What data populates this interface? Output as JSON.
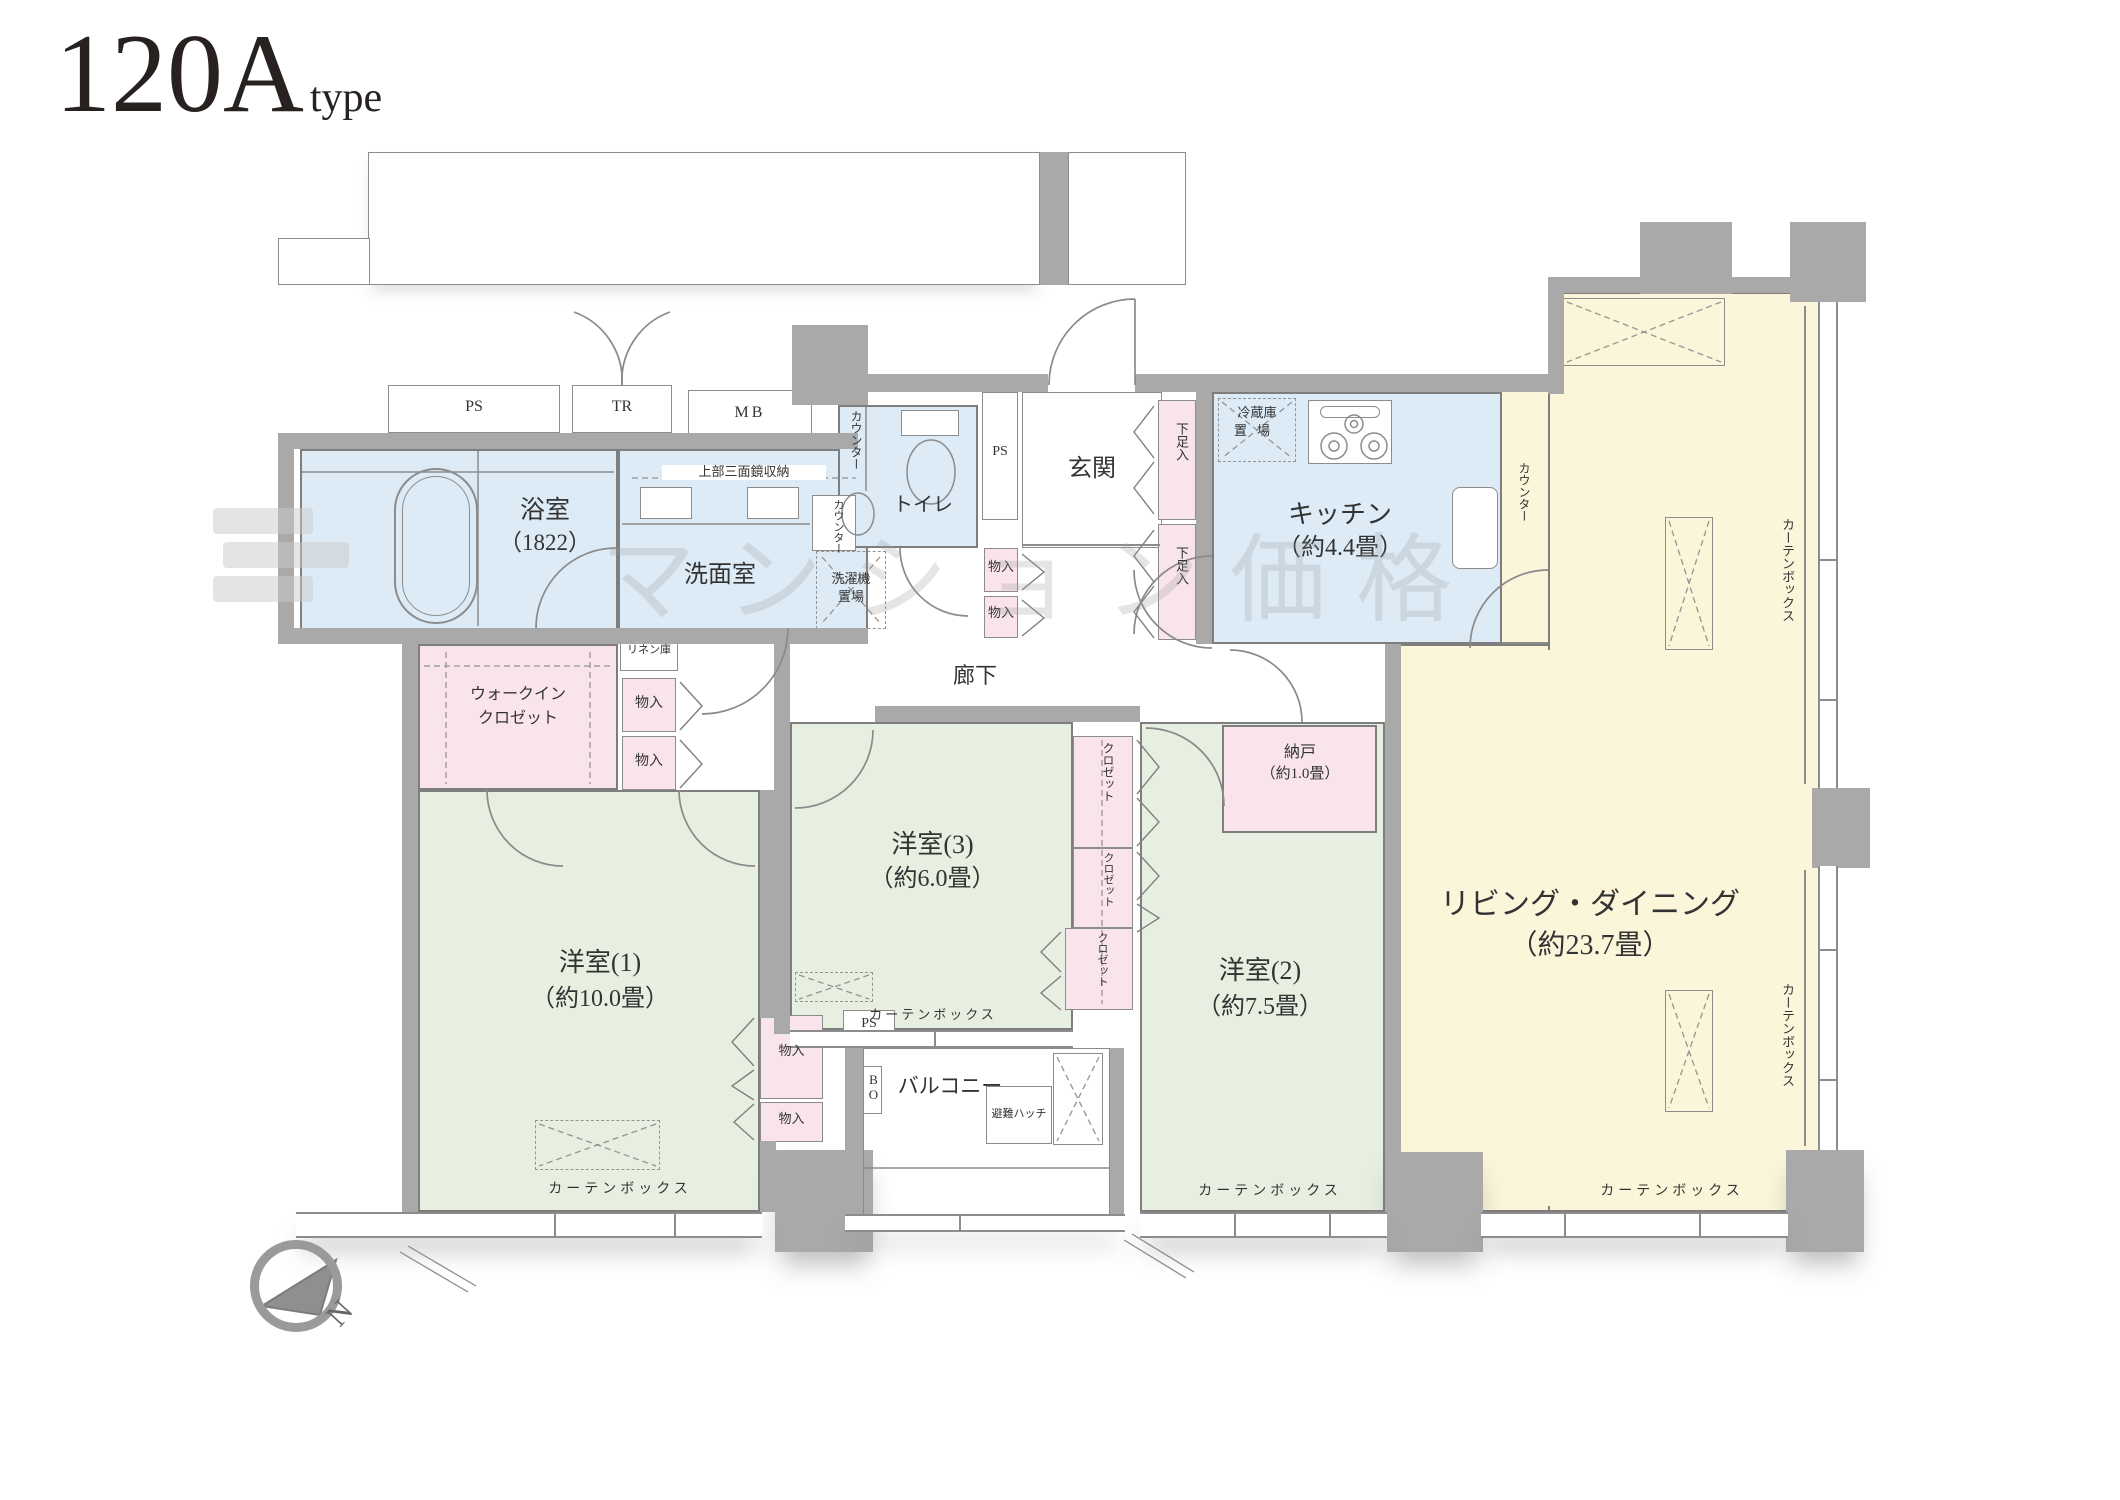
{
  "title": {
    "main": "120A",
    "sub": "type"
  },
  "watermark": "マンション価格",
  "compass": {
    "north": "N"
  },
  "shafts": {
    "ps": "PS",
    "tr": "TR",
    "mb": "MB",
    "bo": "BO"
  },
  "rooms": {
    "bathroom": {
      "name": "浴室",
      "size": "（1822）"
    },
    "washroom": {
      "name": "洗面室"
    },
    "toilet": {
      "name": "トイレ"
    },
    "entrance": {
      "name": "玄関"
    },
    "hallway": {
      "name": "廊下"
    },
    "kitchen": {
      "name": "キッチン",
      "size": "（約4.4畳）"
    },
    "living": {
      "name": "リビング・ダイニング",
      "size": "（約23.7畳）"
    },
    "bedroom1": {
      "name": "洋室(1)",
      "size": "（約10.0畳）"
    },
    "bedroom2": {
      "name": "洋室(2)",
      "size": "（約7.5畳）"
    },
    "bedroom3": {
      "name": "洋室(3)",
      "size": "（約6.0畳）"
    },
    "nando": {
      "name": "納戸",
      "size": "（約1.0畳）"
    },
    "wic": {
      "line1": "ウォークイン",
      "line2": "クロゼット"
    },
    "balcony": {
      "name": "バルコニー"
    }
  },
  "storage": {
    "closet": "クロゼット",
    "linen": "リネン庫",
    "mono": "物入",
    "shoe": "下足入",
    "mirror": "上部三面鏡収納",
    "washer1": "洗濯機",
    "washer2": "置場",
    "fridge1": "冷蔵庫",
    "fridge2": "置場"
  },
  "fixtures": {
    "counter": "カウンター",
    "curtain": "カーテンボックス",
    "hatch": "避難ハッチ"
  }
}
